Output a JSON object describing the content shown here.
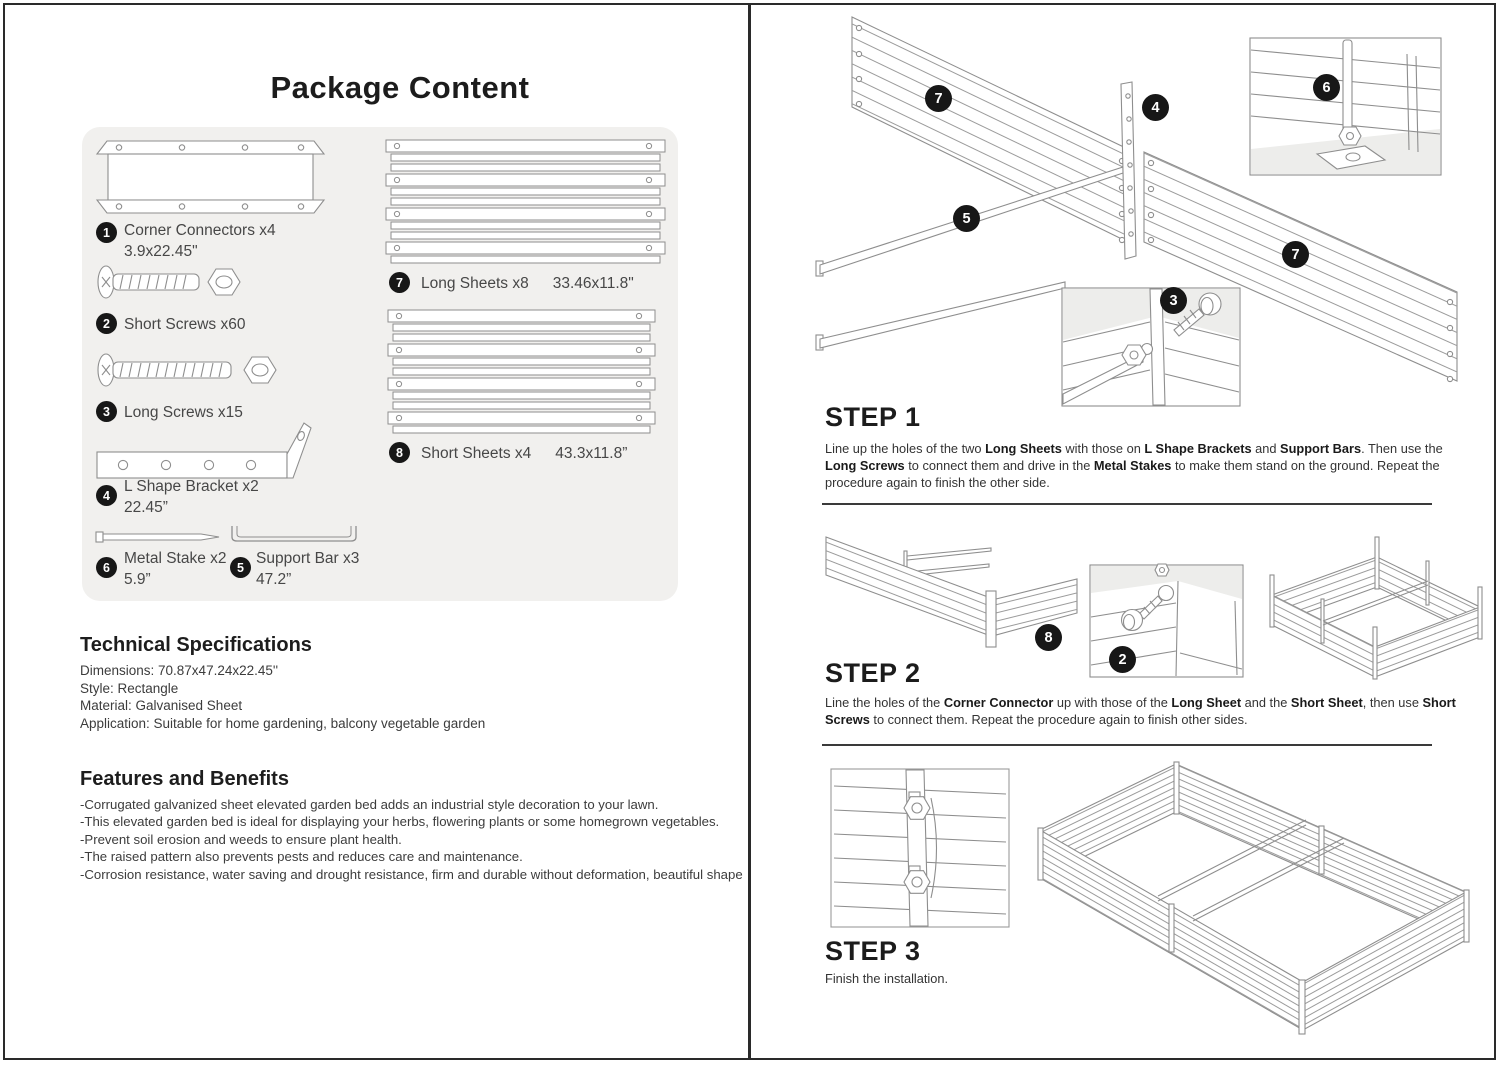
{
  "page": {
    "title": "Package Content"
  },
  "package": {
    "items": [
      {
        "n": "1",
        "label": "Corner Connectors x4",
        "size": "3.9x22.45\""
      },
      {
        "n": "2",
        "label": "Short Screws x60",
        "size": ""
      },
      {
        "n": "3",
        "label": "Long Screws x15",
        "size": ""
      },
      {
        "n": "4",
        "label": "L Shape Bracket x2",
        "size": "22.45”"
      },
      {
        "n": "5",
        "label": "Support Bar x3",
        "size": "47.2”"
      },
      {
        "n": "6",
        "label": "Metal Stake x2",
        "size": "5.9”"
      },
      {
        "n": "7",
        "label": "Long Sheets x8",
        "size": "33.46x11.8\""
      },
      {
        "n": "8",
        "label": "Short Sheets x4",
        "size": "43.3x11.8”"
      }
    ]
  },
  "tech": {
    "heading": "Technical Specifications",
    "lines": [
      "Dimensions:  70.87x47.24x22.45''",
      "Style: Rectangle",
      "Material: Galvanised Sheet",
      "Application: Suitable for home gardening, balcony vegetable garden"
    ]
  },
  "features": {
    "heading": "Features and Benefits",
    "lines": [
      "-Corrugated galvanized sheet elevated garden bed adds an industrial style decoration to your lawn.",
      "-This elevated garden bed is ideal for displaying your herbs, flowering plants or some homegrown vegetables.",
      "-Prevent soil erosion and weeds to ensure plant health.",
      "-The raised pattern also prevents pests and reduces care and maintenance.",
      "-Corrosion resistance, water saving and drought resistance, firm and durable without deformation, beautiful shape"
    ]
  },
  "steps": {
    "step1": {
      "heading": "STEP 1",
      "rich": [
        {
          "t": "Line up the holes of the two "
        },
        {
          "t": "Long Sheets",
          "b": 1
        },
        {
          "t": " with those on "
        },
        {
          "t": "L Shape Brackets",
          "b": 1
        },
        {
          "t": " and "
        },
        {
          "t": "Support Bars",
          "b": 1
        },
        {
          "t": ". Then use the "
        },
        {
          "t": "Long Screws",
          "b": 1
        },
        {
          "t": " to connect them and drive in the "
        },
        {
          "t": "Metal Stakes",
          "b": 1
        },
        {
          "t": " to make them stand on the ground. Repeat the procedure again to finish the other side."
        }
      ]
    },
    "step2": {
      "heading": "STEP 2",
      "rich": [
        {
          "t": "Line the holes of the "
        },
        {
          "t": "Corner Connector",
          "b": 1
        },
        {
          "t": " up with those of the "
        },
        {
          "t": "Long Sheet",
          "b": 1
        },
        {
          "t": " and the "
        },
        {
          "t": "Short Sheet",
          "b": 1
        },
        {
          "t": ", then use "
        },
        {
          "t": "Short Screws",
          "b": 1
        },
        {
          "t": " to connect them. Repeat the procedure again to finish other sides."
        }
      ]
    },
    "step3": {
      "heading": "STEP 3",
      "text": "Finish the installation."
    }
  },
  "callouts": {
    "step1": [
      "7",
      "4",
      "6",
      "5",
      "3",
      "7"
    ],
    "step2": [
      "8",
      "2"
    ]
  },
  "colors": {
    "callout_bg": "#171717",
    "line_art": "#8e8e8e",
    "panel_bg": "#f1f0ee"
  }
}
